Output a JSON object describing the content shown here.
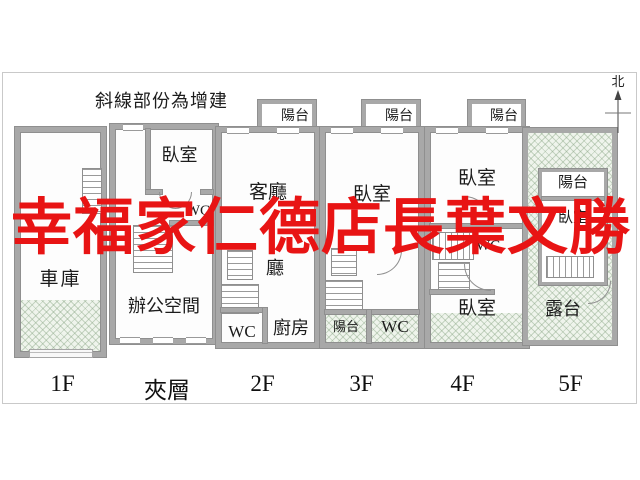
{
  "note": "斜線部份為增建",
  "compass": {
    "label": "北"
  },
  "watermark": {
    "text": "幸福家仁德店長葉文勝",
    "color": "#e81414"
  },
  "colors": {
    "wall": "#a8a8a8",
    "hatch_fill": "#eff4ec",
    "watermark_red": "#e81414"
  },
  "floors": [
    {
      "label": "1F",
      "rooms": {
        "garage": "車庫"
      }
    },
    {
      "label": "夾層",
      "rooms": {
        "bedroom": "臥室",
        "wc": "WC",
        "office": "辦公空間"
      }
    },
    {
      "label": "2F",
      "rooms": {
        "balcony": "陽台",
        "living_room": "客廳",
        "dining_room": "廳",
        "wc": "WC",
        "kitchen": "廚房"
      }
    },
    {
      "label": "3F",
      "rooms": {
        "balcony_front": "陽台",
        "bedroom": "臥室",
        "balcony_rear": "陽台",
        "wc": "WC"
      }
    },
    {
      "label": "4F",
      "rooms": {
        "balcony": "陽台",
        "bedroom_front": "臥室",
        "wc": "WC",
        "bedroom_rear": "臥室"
      }
    },
    {
      "label": "5F",
      "rooms": {
        "balcony": "陽台",
        "bedroom": "臥室",
        "terrace": "露台"
      }
    }
  ]
}
